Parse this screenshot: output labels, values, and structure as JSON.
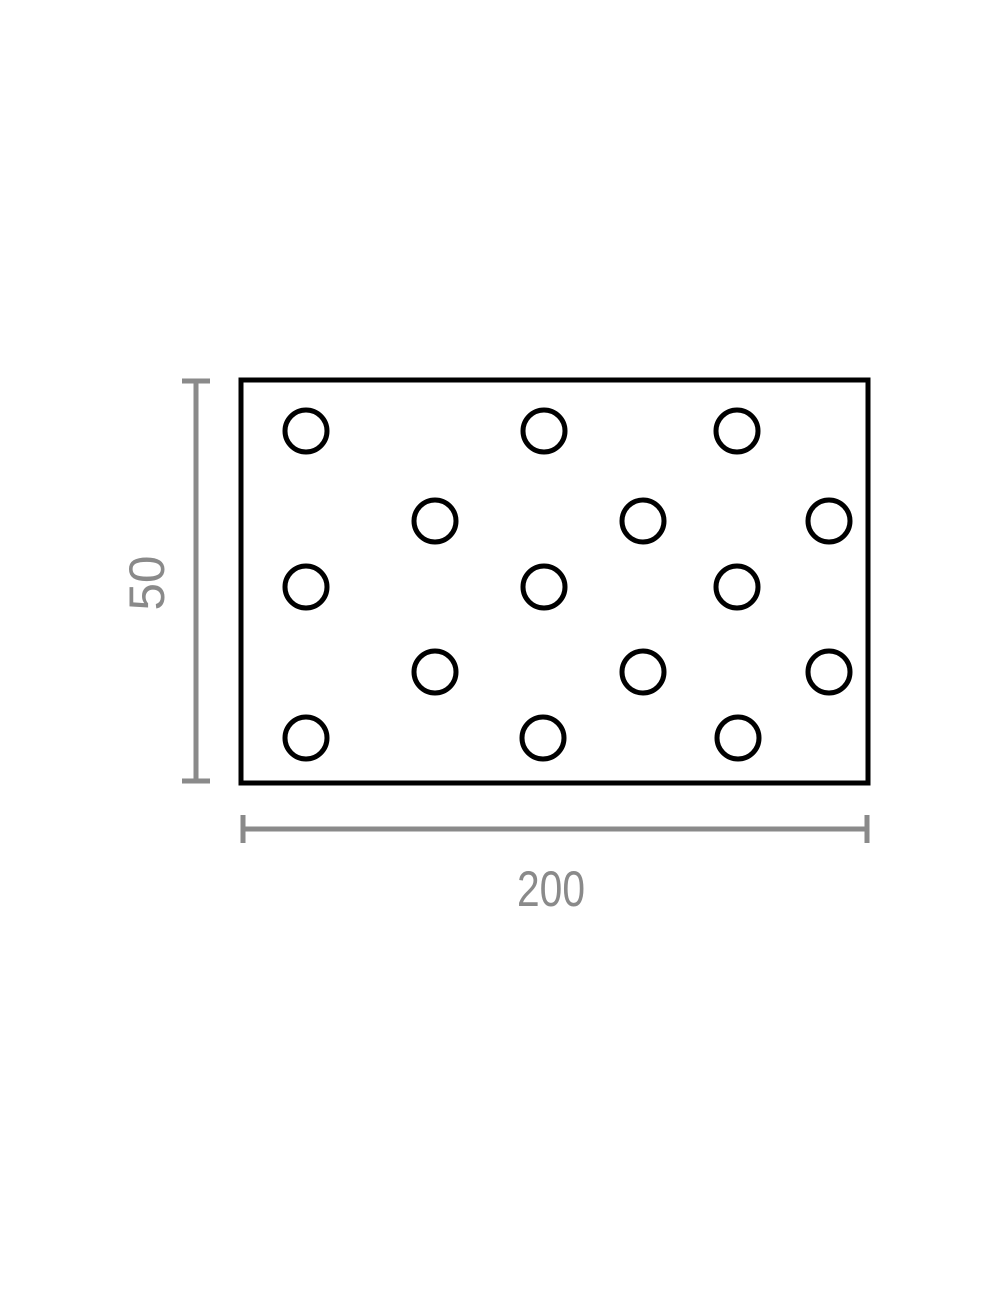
{
  "diagram": {
    "type": "technical-dimension-drawing",
    "subject": "perforated-plate",
    "colors": {
      "outline": "#000000",
      "dimension": "#8a8a8a",
      "background": "#ffffff"
    },
    "plate": {
      "x": 241,
      "y": 380,
      "width": 627,
      "height": 403
    },
    "holes": {
      "count": 15,
      "radius": 21,
      "centers": [
        [
          306,
          431
        ],
        [
          544,
          431
        ],
        [
          737,
          431
        ],
        [
          435,
          521
        ],
        [
          643,
          521
        ],
        [
          829,
          521
        ],
        [
          306,
          587
        ],
        [
          544,
          587
        ],
        [
          737,
          587
        ],
        [
          435,
          672
        ],
        [
          643,
          672
        ],
        [
          829,
          672
        ],
        [
          306,
          738
        ],
        [
          543,
          738
        ],
        [
          738,
          738
        ]
      ]
    },
    "dimensions": {
      "height": {
        "label": "50",
        "line": {
          "x": 196,
          "y1": 381,
          "y2": 781
        },
        "tick_half_width": 14,
        "label_center": {
          "x": 147,
          "y": 583
        }
      },
      "width": {
        "label": "200",
        "line": {
          "y": 829,
          "x1": 243,
          "x2": 867
        },
        "tick_half_height": 14,
        "label_center": {
          "x": 551,
          "y": 889
        }
      }
    }
  }
}
